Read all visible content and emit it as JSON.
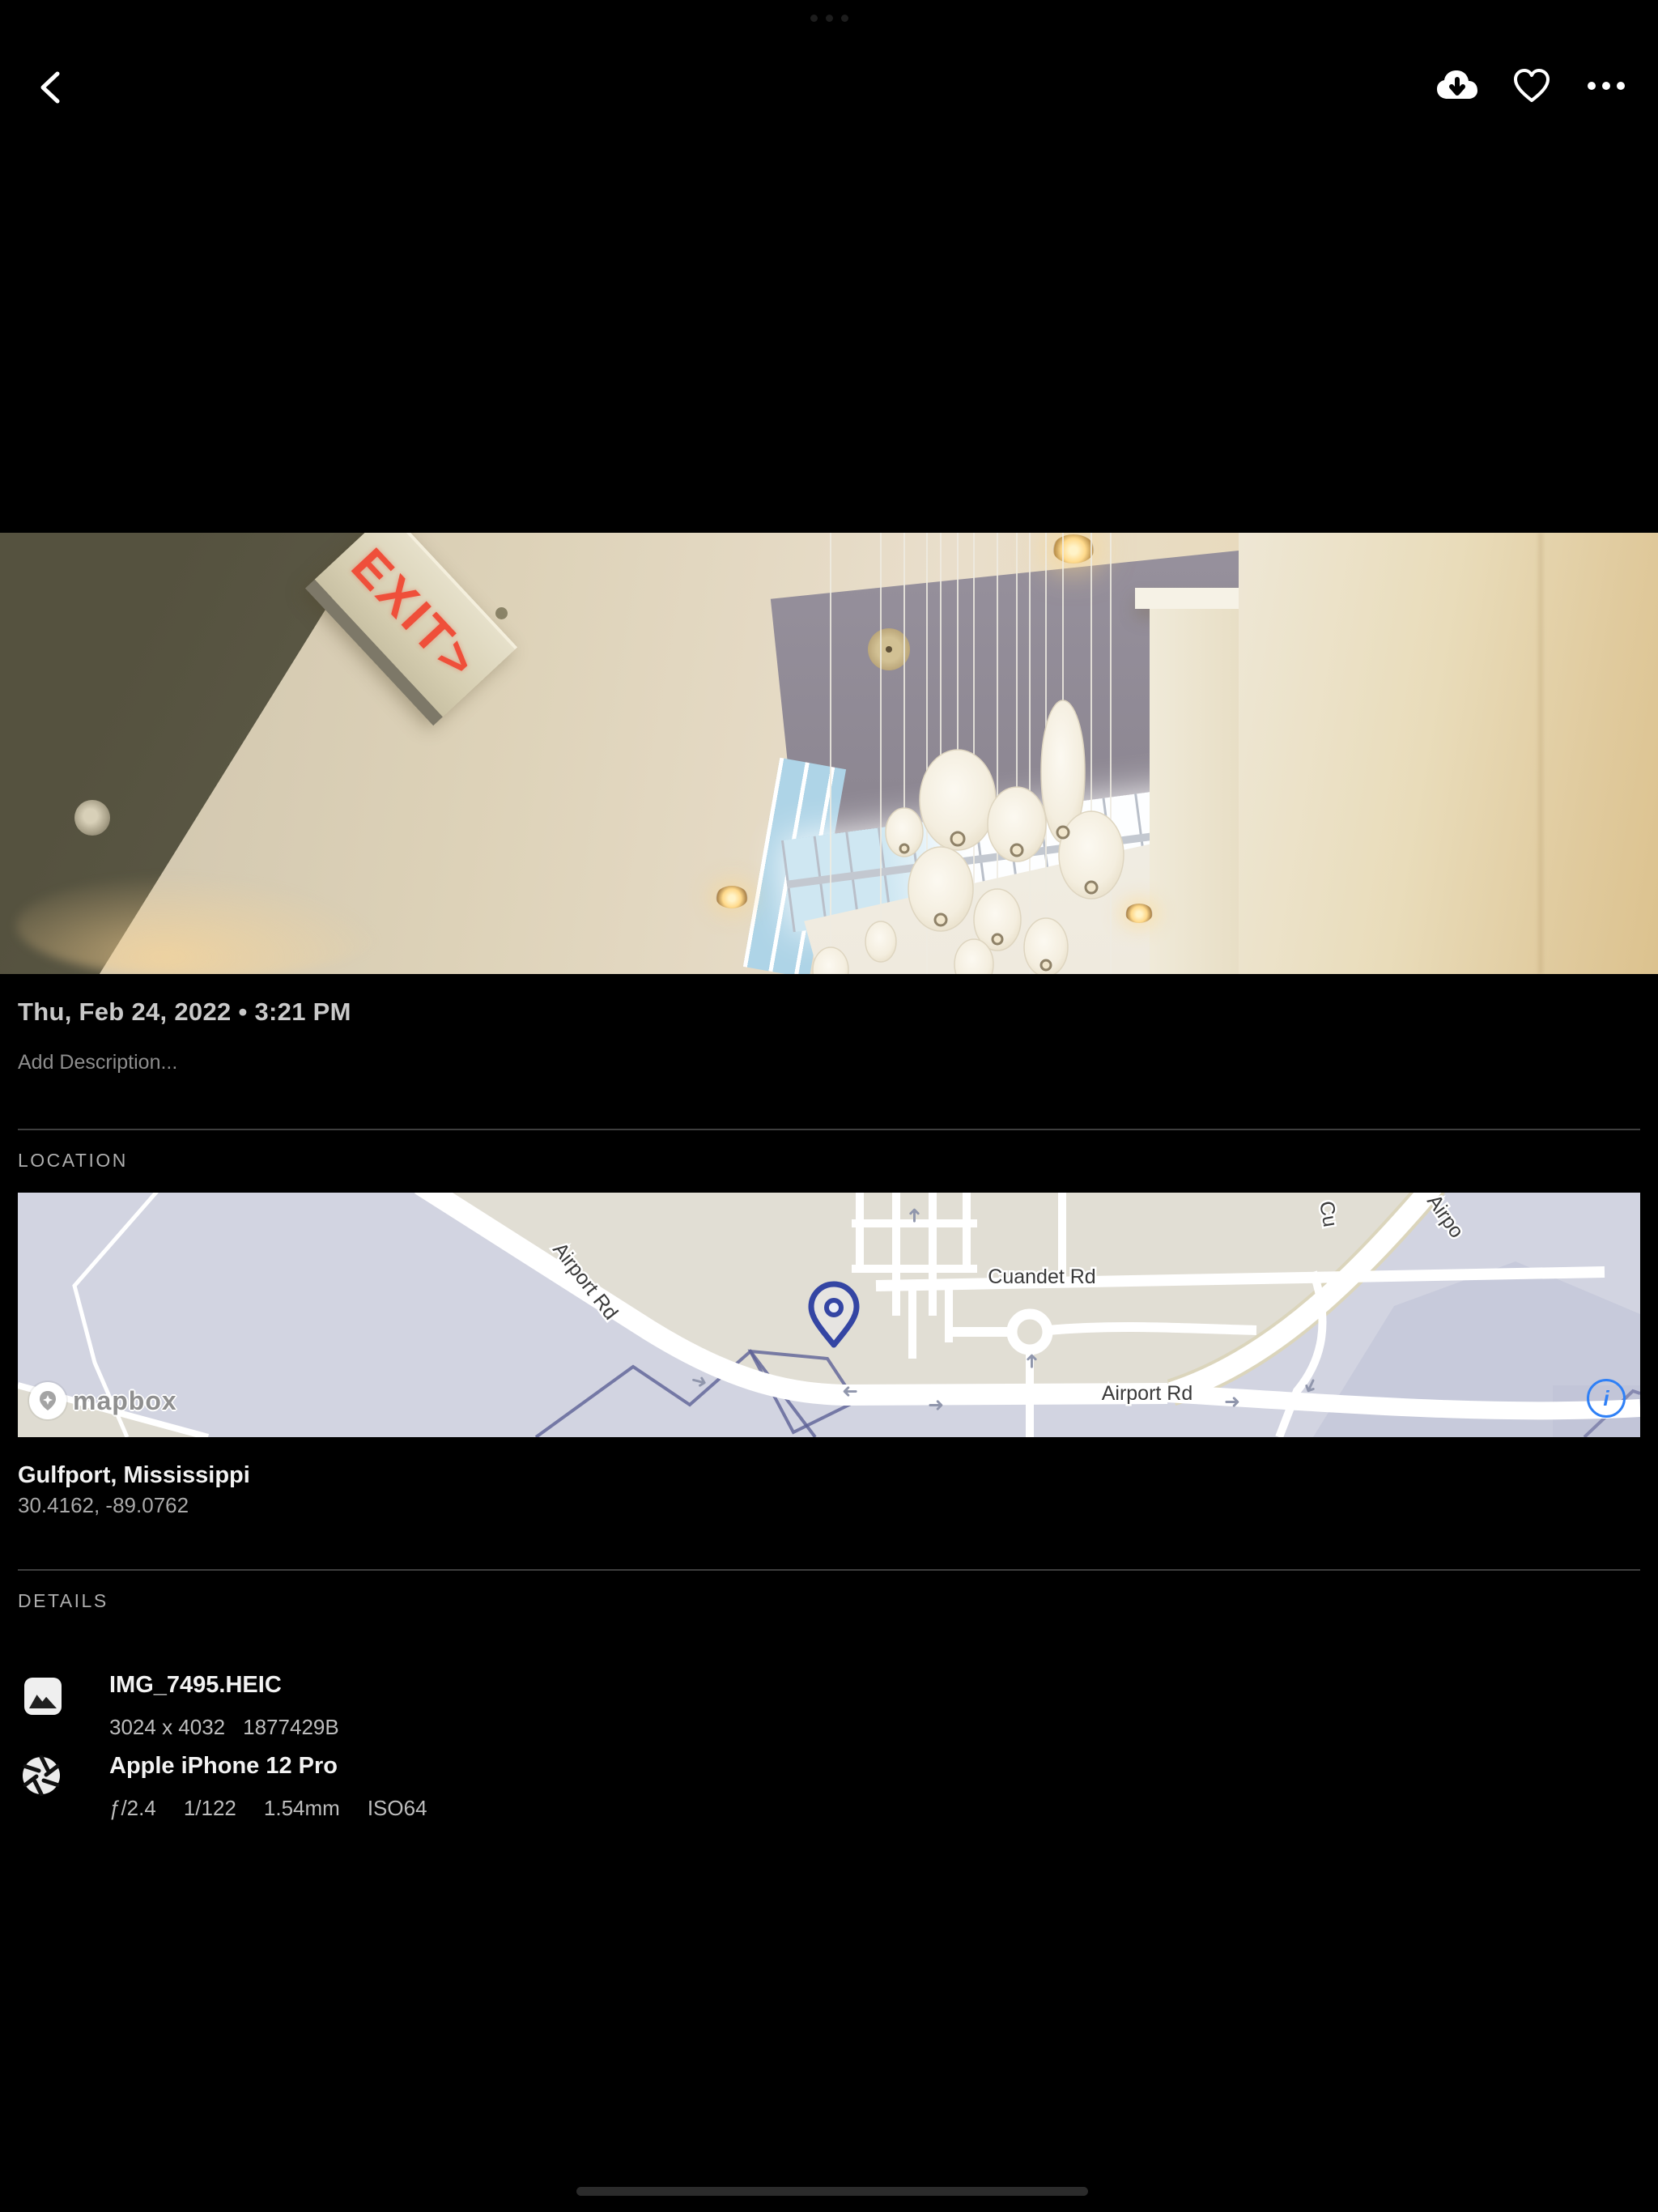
{
  "toolbar": {},
  "photo": {
    "exit_sign_text": "EXIT>"
  },
  "meta": {
    "date": "Thu, Feb 24, 2022 • 3:21 PM",
    "description_placeholder": "Add Description..."
  },
  "location": {
    "section_label": "LOCATION",
    "place": "Gulfport, Mississippi",
    "coordinates": "30.4162, -89.0762",
    "map": {
      "airport_rd_diagonal": "Airport Rd",
      "airport_rd_horizontal": "Airport Rd",
      "cuandet_rd": "Cuandet Rd",
      "airport_rd_partial": "Airpo",
      "cuandet_partial": "Cu",
      "attribution": "mapbox",
      "info_glyph": "i"
    }
  },
  "details": {
    "section_label": "DETAILS",
    "file": {
      "name": "IMG_7495.HEIC",
      "dimensions": "3024 x 4032",
      "size": "1877429B"
    },
    "camera": {
      "name": "Apple iPhone 12 Pro",
      "exif": [
        "ƒ/2.4",
        "1/122",
        "1.54mm",
        "ISO64"
      ]
    }
  },
  "colors": {
    "accent_blue": "#2f80f6",
    "map_pin": "#3445a3",
    "exit_red": "#ef4f3a"
  }
}
